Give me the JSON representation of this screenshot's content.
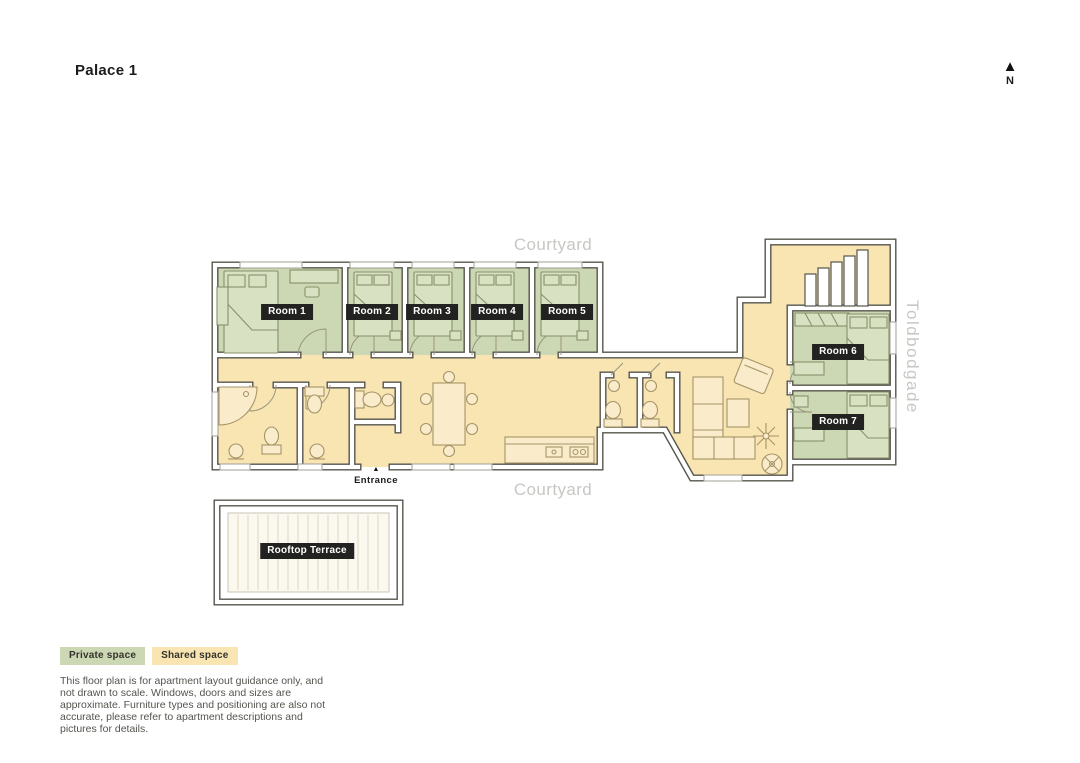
{
  "title": "Palace 1",
  "compass": {
    "label": "N"
  },
  "plan": {
    "courtyard_top": "Courtyard",
    "courtyard_bottom": "Courtyard",
    "street": "Toldbodgade",
    "entrance_label": "Entrance",
    "terrace_label": "Rooftop Terrace",
    "rooms": [
      {
        "label": "Room 1"
      },
      {
        "label": "Room 2"
      },
      {
        "label": "Room 3"
      },
      {
        "label": "Room 4"
      },
      {
        "label": "Room 5"
      },
      {
        "label": "Room 6"
      },
      {
        "label": "Room 7"
      }
    ]
  },
  "legend": {
    "private_label": "Private space",
    "shared_label": "Shared space"
  },
  "disclaimer": "This floor plan is for apartment layout guidance only, and not drawn to scale. Windows, doors and sizes are approximate. Furniture types and positioning are also not accurate, please refer to apartment descriptions and pictures for details.",
  "colors": {
    "private_space": "#ccd7b3",
    "shared_space": "#f8e5b2",
    "wall_line": "#55554d",
    "label_chip_bg": "#222220",
    "muted_text": "#c7c7c4"
  }
}
